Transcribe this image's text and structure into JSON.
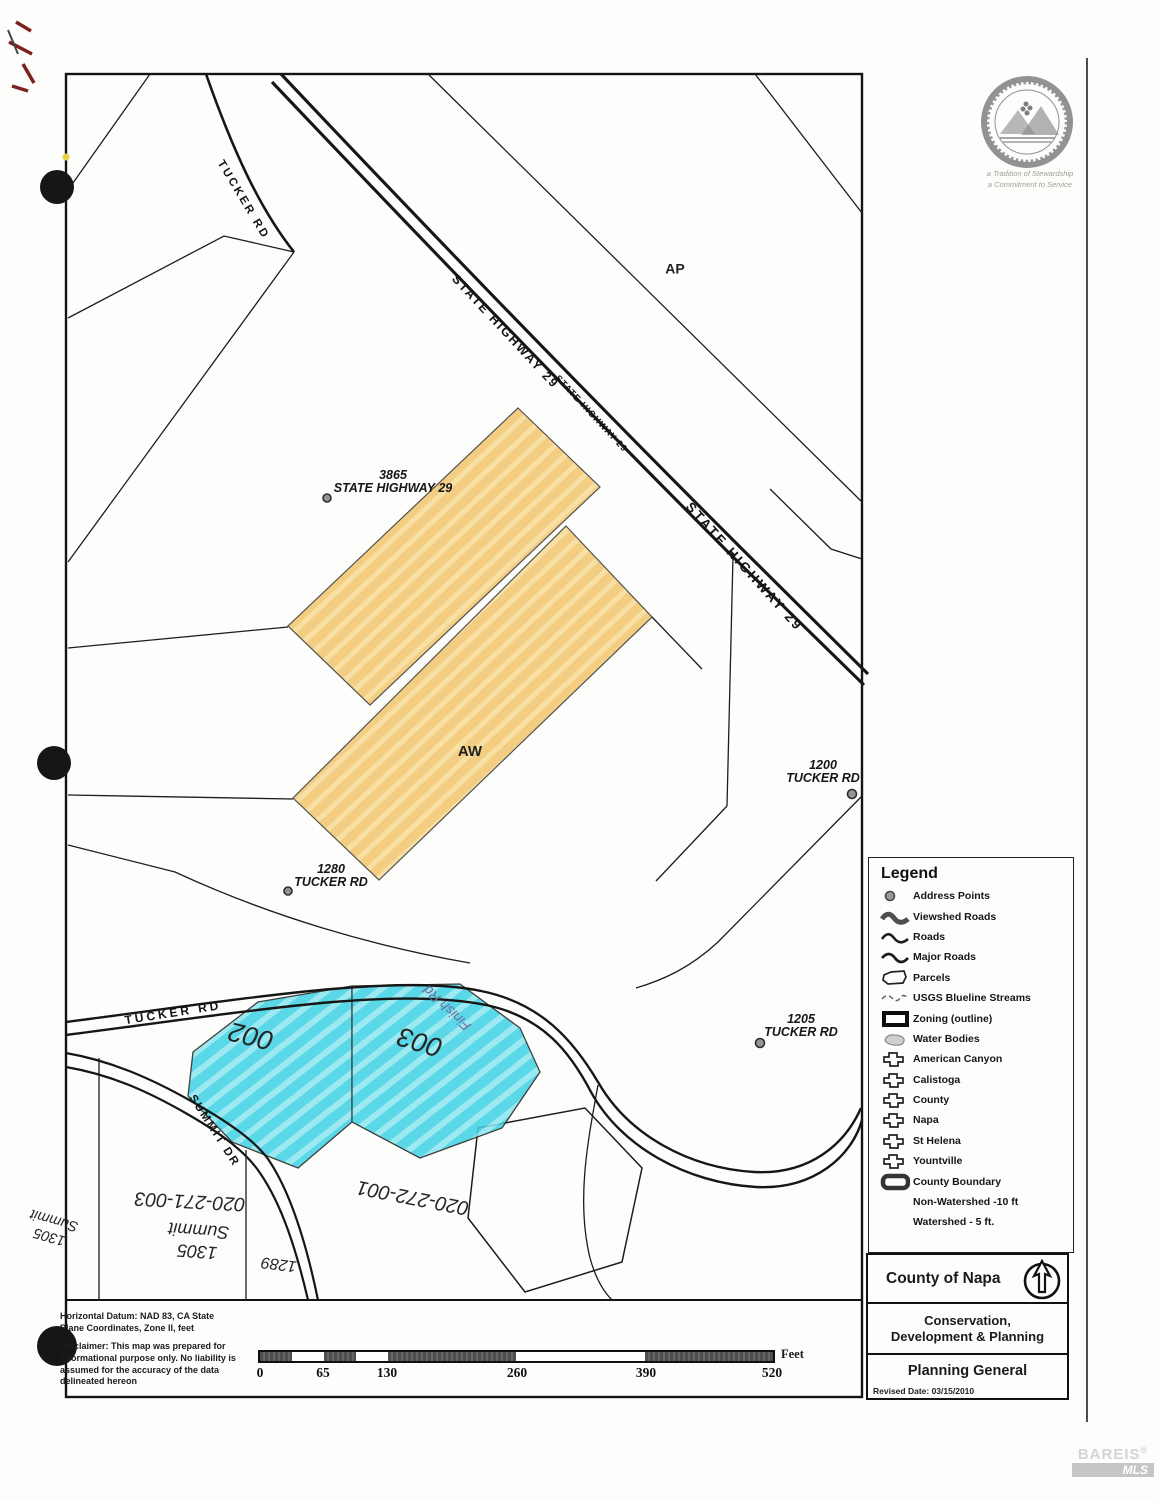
{
  "seal": {
    "tagline_line1": "a Tradition of Stewardship",
    "tagline_line2": "a Commitment to Service"
  },
  "watermark": {
    "name": "BAREIS",
    "registered": "®",
    "sub": "MLS"
  },
  "roads": {
    "tucker_upper": "TUCKER RD",
    "highway_label_large": "STATE HIGHWAY 29",
    "highway_label_small": "STATE HIGHWAY 29",
    "highway_label_lower": "STATE HIGHWAY 29",
    "tucker_lower": "TUCKER RD",
    "summit_dr": "SUMMIT DR"
  },
  "zoning_labels": {
    "ap": "AP",
    "aw": "AW"
  },
  "address_points": [
    {
      "number": "3865",
      "street": "STATE HIGHWAY 29"
    },
    {
      "number": "1280",
      "street": "TUCKER RD"
    },
    {
      "number": "1200",
      "street": "TUCKER RD"
    },
    {
      "number": "1205",
      "street": "TUCKER RD"
    }
  ],
  "annotations": {
    "parcel_002": "002",
    "parcel_003": "003",
    "finish_rd": "Finish Rd",
    "apn_020_271_003": "020-271-003",
    "summit_1305_number": "1305",
    "summit_1305_name": "Summit",
    "apn_020_272_001": "020-272-001",
    "number_1289": "1289",
    "margin_number": "1305",
    "margin_name": "Summit"
  },
  "legend": {
    "title": "Legend",
    "items": [
      {
        "label": "Address Points",
        "icon": "address-point-icon"
      },
      {
        "label": "Viewshed Roads",
        "icon": "viewshed-road-icon"
      },
      {
        "label": "Roads",
        "icon": "road-icon"
      },
      {
        "label": "Major Roads",
        "icon": "major-road-icon"
      },
      {
        "label": "Parcels",
        "icon": "parcel-icon"
      },
      {
        "label": "USGS Blueline Streams",
        "icon": "stream-icon"
      },
      {
        "label": "Zoning (outline)",
        "icon": "zoning-outline-icon"
      },
      {
        "label": "Water Bodies",
        "icon": "water-body-icon"
      },
      {
        "label": "American Canyon",
        "icon": "city-boundary-icon"
      },
      {
        "label": "Calistoga",
        "icon": "city-boundary-icon"
      },
      {
        "label": "County",
        "icon": "city-boundary-icon"
      },
      {
        "label": "Napa",
        "icon": "city-boundary-icon"
      },
      {
        "label": "St Helena",
        "icon": "city-boundary-icon"
      },
      {
        "label": "Yountville",
        "icon": "city-boundary-icon"
      },
      {
        "label": "County Boundary",
        "icon": "county-boundary-icon"
      },
      {
        "label": "Non-Watershed -10 ft",
        "icon": ""
      },
      {
        "label": "Watershed - 5 ft.",
        "icon": ""
      }
    ]
  },
  "scale_bar": {
    "ticks": [
      "0",
      "65",
      "130",
      "260",
      "390",
      "520"
    ],
    "unit": "Feet"
  },
  "title_block": {
    "agency": "County of Napa",
    "department": "Conservation, Development & Planning",
    "map_type": "Planning General",
    "revised": "Revised Date: 03/15/2010"
  },
  "notes": {
    "datum": "Horizontal Datum: NAD 83, CA State Plane Coordinates, Zone II, feet",
    "disclaimer": "Disclaimer: This map was prepared for informational purpose only.  No liability is assumed for the accuracy of the data delineated hereon"
  },
  "colors": {
    "highlight_orange": "#f4c96e",
    "highlight_cyan": "#46d6e6",
    "ink": "#1a1a1a"
  }
}
